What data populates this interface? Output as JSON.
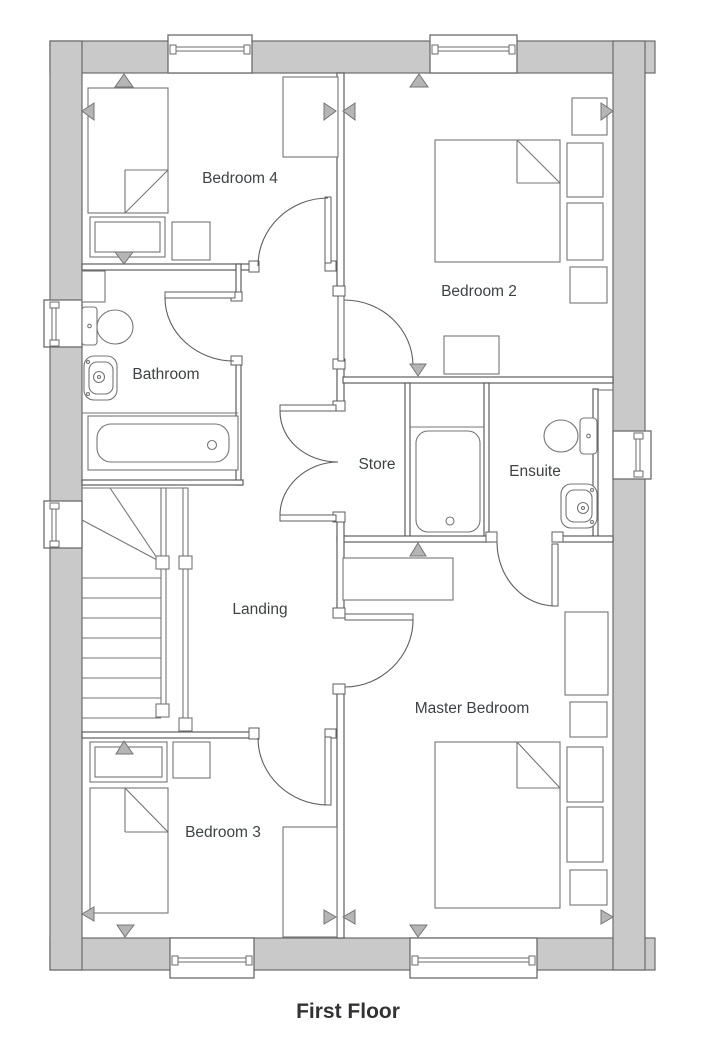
{
  "title": "First Floor",
  "rooms": {
    "bedroom4": {
      "label": "Bedroom 4"
    },
    "bedroom2": {
      "label": "Bedroom 2"
    },
    "bathroom": {
      "label": "Bathroom"
    },
    "store": {
      "label": "Store"
    },
    "ensuite": {
      "label": "Ensuite"
    },
    "landing": {
      "label": "Landing"
    },
    "bedroom3": {
      "label": "Bedroom 3"
    },
    "master_bedroom": {
      "label": "Master Bedroom"
    }
  },
  "colors": {
    "background": "#ffffff",
    "outer_wall_fill": "#c9c9c9",
    "wall_line": "#6b6b6b",
    "interior_line": "#5d5d5d",
    "furniture_line": "#757575",
    "marker_fill": "#b5b5b5",
    "room_label": "#3f4245",
    "title": "#323234"
  }
}
